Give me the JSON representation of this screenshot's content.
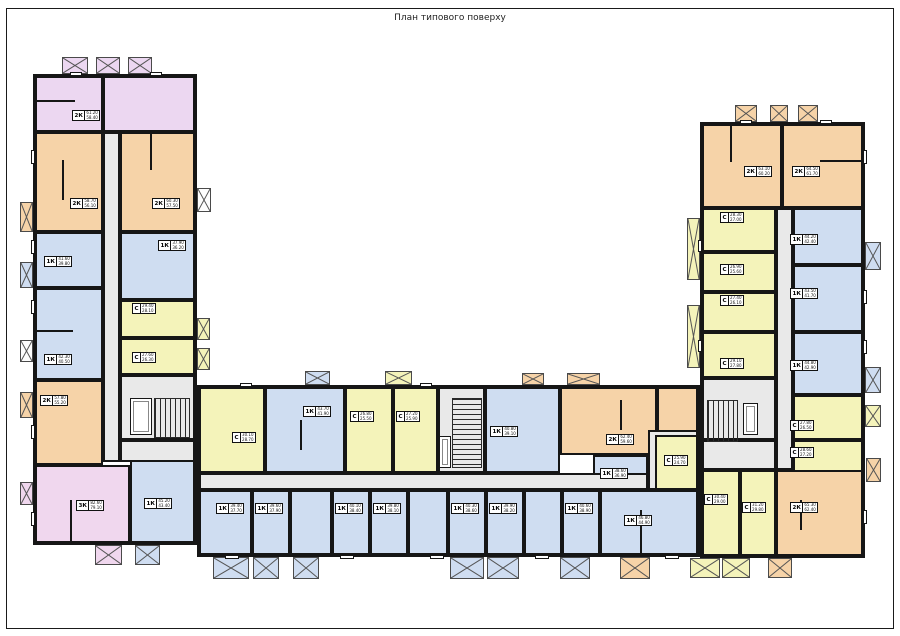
{
  "title": "План типового поверху",
  "colors": {
    "wall": "#161616",
    "corridor": "#e9e9e9",
    "lavender_2k": "#ecd7f1",
    "peach_2k": "#f6d3a8",
    "blue_1k": "#cfddf1",
    "yellow_studio": "#f4f3ba",
    "pink_3k": "#f0d7ee"
  },
  "apartment_types": {
    "studio": "С",
    "one_room": "1К",
    "two_room": "2К",
    "three_room": "3К"
  },
  "apartments": [
    {
      "id": "A1",
      "type": "2К",
      "area_total": "61.20",
      "area_living": "58.40"
    },
    {
      "id": "A2",
      "type": "2К",
      "area_total": "58.70",
      "area_living": "56.10"
    },
    {
      "id": "A3",
      "type": "2К",
      "area_total": "60.30",
      "area_living": "57.50"
    },
    {
      "id": "A4",
      "type": "1К",
      "area_total": "41.60",
      "area_living": "39.80"
    },
    {
      "id": "A5",
      "type": "1К",
      "area_total": "37.90",
      "area_living": "36.20"
    },
    {
      "id": "A6",
      "type": "С",
      "area_total": "29.40",
      "area_living": "28.10"
    },
    {
      "id": "A7",
      "type": "С",
      "area_total": "27.60",
      "area_living": "26.30"
    },
    {
      "id": "A8",
      "type": "1К",
      "area_total": "42.30",
      "area_living": "40.50"
    },
    {
      "id": "A9",
      "type": "2К",
      "area_total": "57.80",
      "area_living": "55.20"
    },
    {
      "id": "A10",
      "type": "3К",
      "area_total": "82.60",
      "area_living": "79.10"
    },
    {
      "id": "A11",
      "type": "1К",
      "area_total": "45.20",
      "area_living": "43.40"
    },
    {
      "id": "B1",
      "type": "С",
      "area_total": "30.10",
      "area_living": "28.70"
    },
    {
      "id": "B2",
      "type": "1К",
      "area_total": "43.70",
      "area_living": "41.90"
    },
    {
      "id": "B3",
      "type": "С",
      "area_total": "26.80",
      "area_living": "25.50"
    },
    {
      "id": "B4",
      "type": "С",
      "area_total": "27.20",
      "area_living": "25.90"
    },
    {
      "id": "B5",
      "type": "1К",
      "area_total": "40.80",
      "area_living": "39.10"
    },
    {
      "id": "B6",
      "type": "2К",
      "area_total": "62.40",
      "area_living": "59.60"
    },
    {
      "id": "B7",
      "type": "1К",
      "area_total": "38.60",
      "area_living": "36.90"
    },
    {
      "id": "C1",
      "type": "1К",
      "area_total": "39.40",
      "area_living": "37.70"
    },
    {
      "id": "C2",
      "type": "1К",
      "area_total": "39.60",
      "area_living": "37.90"
    },
    {
      "id": "C3",
      "type": "1К",
      "area_total": "40.10",
      "area_living": "38.40"
    },
    {
      "id": "C4",
      "type": "1К",
      "area_total": "39.80",
      "area_living": "38.10"
    },
    {
      "id": "C5",
      "type": "1К",
      "area_total": "40.30",
      "area_living": "38.60"
    },
    {
      "id": "C6",
      "type": "1К",
      "area_total": "39.90",
      "area_living": "38.20"
    },
    {
      "id": "C7",
      "type": "1К",
      "area_total": "40.60",
      "area_living": "38.90"
    },
    {
      "id": "C8",
      "type": "1К",
      "area_total": "46.80",
      "area_living": "44.90"
    },
    {
      "id": "D1",
      "type": "2К",
      "area_total": "63.10",
      "area_living": "60.20"
    },
    {
      "id": "D2",
      "type": "2К",
      "area_total": "64.50",
      "area_living": "61.70"
    },
    {
      "id": "D3",
      "type": "С",
      "area_total": "28.30",
      "area_living": "27.00"
    },
    {
      "id": "D4",
      "type": "С",
      "area_total": "26.90",
      "area_living": "25.60"
    },
    {
      "id": "D5",
      "type": "С",
      "area_total": "27.40",
      "area_living": "26.10"
    },
    {
      "id": "D6",
      "type": "С",
      "area_total": "29.10",
      "area_living": "27.80"
    },
    {
      "id": "D7",
      "type": "1К",
      "area_total": "44.20",
      "area_living": "42.40"
    },
    {
      "id": "D8",
      "type": "1К",
      "area_total": "43.50",
      "area_living": "41.70"
    },
    {
      "id": "D9",
      "type": "1К",
      "area_total": "44.80",
      "area_living": "42.90"
    },
    {
      "id": "D10",
      "type": "С",
      "area_total": "27.80",
      "area_living": "26.50"
    },
    {
      "id": "D11",
      "type": "С",
      "area_total": "28.60",
      "area_living": "27.20"
    },
    {
      "id": "D12",
      "type": "С",
      "area_total": "25.90",
      "area_living": "24.70"
    },
    {
      "id": "D13",
      "type": "С",
      "area_total": "30.40",
      "area_living": "29.00"
    },
    {
      "id": "D14",
      "type": "С",
      "area_total": "31.20",
      "area_living": "29.80"
    },
    {
      "id": "D15",
      "type": "2К",
      "area_total": "65.30",
      "area_living": "62.40"
    }
  ]
}
